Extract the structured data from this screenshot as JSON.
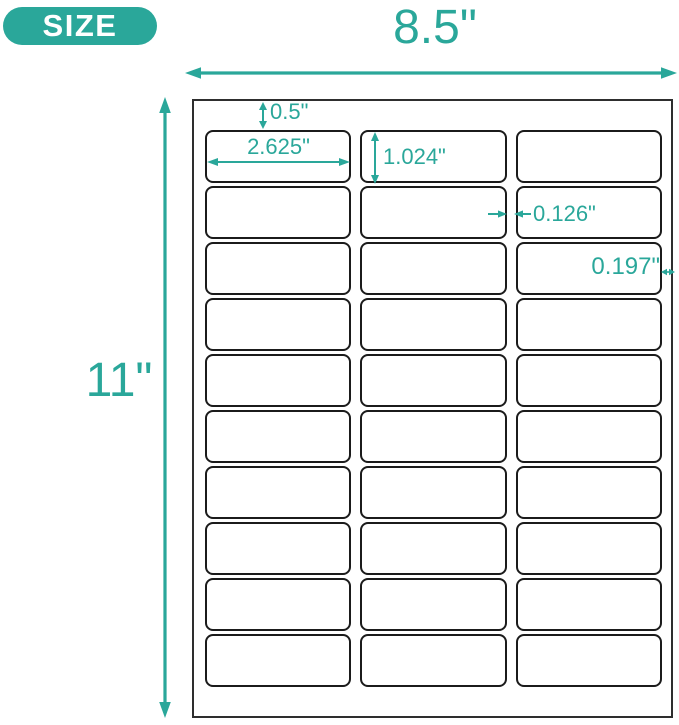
{
  "badge": {
    "label": "SIZE"
  },
  "dimensions": {
    "sheet_width": "8.5\"",
    "sheet_height": "11\"",
    "top_margin": "0.5\"",
    "label_width": "2.625\"",
    "label_height": "1.024\"",
    "column_gap": "0.126\"",
    "side_margin": "0.197\""
  },
  "sheet": {
    "rows": 10,
    "columns": 3
  },
  "colors": {
    "accent": "#2aa79a",
    "badge_background": "#2aa79a",
    "badge_text": "#ffffff",
    "label_border": "#1b1b1b",
    "sheet_border": "#2e2e2e",
    "background": "#ffffff"
  }
}
